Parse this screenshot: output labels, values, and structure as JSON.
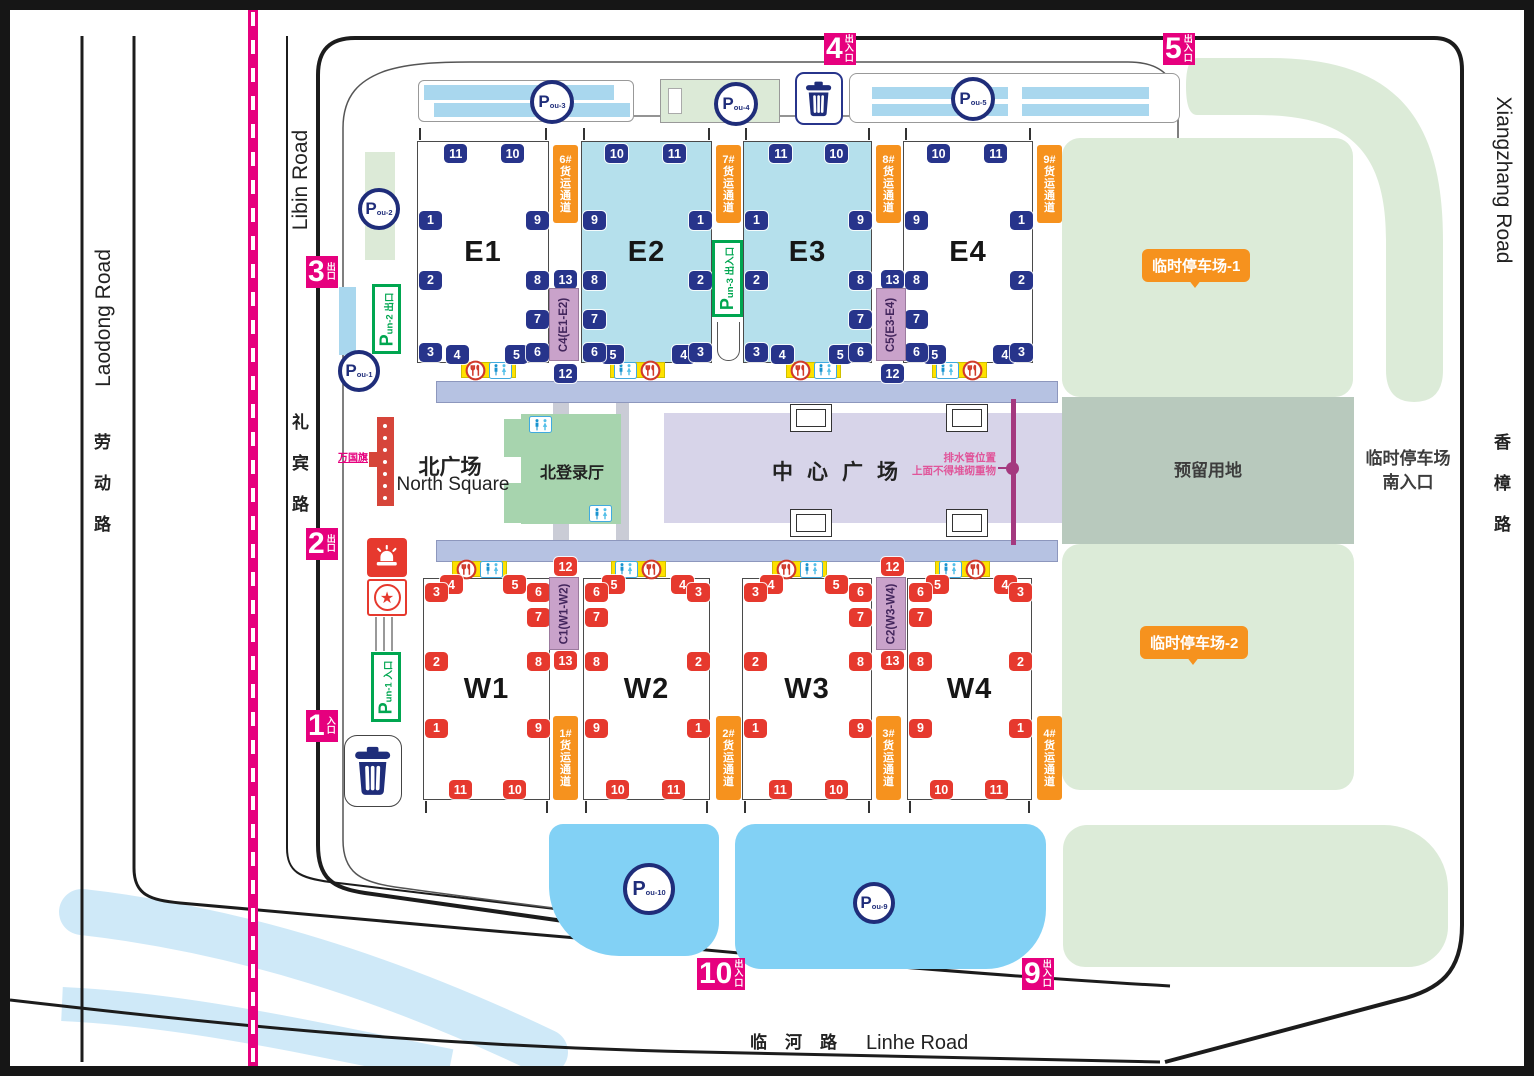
{
  "roads": {
    "laodong_en": "Laodong Road",
    "laodong_zh": "劳动路",
    "libin_en": "Libin Road",
    "libin_zh": "礼宾路",
    "xiangzhang_en": "Xiangzhang Road",
    "xiangzhang_zh": "香樟路",
    "linhe_zh": "临河路",
    "linhe_en": "Linhe Road"
  },
  "areas": {
    "north_square_zh": "北广场",
    "north_square_en": "North Square",
    "north_hall": "北登录厅",
    "central_square": "中心广场",
    "reserved": "预留用地",
    "parking1": "临时停车场-1",
    "parking2": "临时停车场-2",
    "south_entrance_line1": "临时停车场",
    "south_entrance_line2": "南入口"
  },
  "annotations": {
    "flags": "万国旗",
    "drain1": "排水管位置",
    "drain2": "上面不得堆砌重物"
  },
  "entrances": [
    {
      "id": "g1",
      "num": "1",
      "suffix": "入口"
    },
    {
      "id": "g2",
      "num": "2",
      "suffix": "出口"
    },
    {
      "id": "g3",
      "num": "3",
      "suffix": "出口"
    },
    {
      "id": "g4",
      "num": "4",
      "suffix": "出入口"
    },
    {
      "id": "g5",
      "num": "5",
      "suffix": "出入口"
    },
    {
      "id": "g9",
      "num": "9",
      "suffix": "出入口"
    },
    {
      "id": "g10",
      "num": "10",
      "suffix": "出入口"
    }
  ],
  "p_circles": [
    {
      "id": "pou1",
      "label": "Pou-1"
    },
    {
      "id": "pou2",
      "label": "Pou-2"
    },
    {
      "id": "pou3",
      "label": "Pou-3"
    },
    {
      "id": "pou4",
      "label": "Pou-4"
    },
    {
      "id": "pou5",
      "label": "Pou-5"
    },
    {
      "id": "pou9",
      "label": "Pou-9"
    },
    {
      "id": "pou10",
      "label": "Pou-10"
    }
  ],
  "p_gates": [
    {
      "id": "pun1",
      "label": "Pun-1",
      "suffix": "入口"
    },
    {
      "id": "pun2",
      "label": "Pun-2",
      "suffix": "出口"
    },
    {
      "id": "pun3",
      "label": "Pun-3",
      "suffix": "出入口"
    }
  ],
  "freight_lanes": [
    {
      "id": "lane6",
      "label": "6#货运通道"
    },
    {
      "id": "lane7",
      "label": "7#货运通道"
    },
    {
      "id": "lane8",
      "label": "8#货运通道"
    },
    {
      "id": "lane9",
      "label": "9#货运通道"
    },
    {
      "id": "lane1",
      "label": "1#货运通道"
    },
    {
      "id": "lane2",
      "label": "2#货运通道"
    },
    {
      "id": "lane3",
      "label": "3#货运通道"
    },
    {
      "id": "lane4",
      "label": "4#货运通道"
    }
  ],
  "corridor_links": [
    {
      "id": "C4",
      "label": "C4(E1-E2)",
      "top": "13",
      "bottom": "12"
    },
    {
      "id": "C5",
      "label": "C5(E3-E4)",
      "top": "13",
      "bottom": "12"
    },
    {
      "id": "C1",
      "label": "C1(W1-W2)",
      "top": "12",
      "bottom": "13"
    },
    {
      "id": "C2",
      "label": "C2(W3-W4)",
      "top": "12",
      "bottom": "13"
    }
  ],
  "halls": [
    {
      "id": "E1",
      "label": "E1",
      "pattern": "A",
      "color": "white",
      "badge": "navy"
    },
    {
      "id": "E2",
      "label": "E2",
      "pattern": "B",
      "color": "blue",
      "badge": "navy"
    },
    {
      "id": "E3",
      "label": "E3",
      "pattern": "A",
      "color": "blue",
      "badge": "navy"
    },
    {
      "id": "E4",
      "label": "E4",
      "pattern": "B",
      "color": "white",
      "badge": "navy"
    },
    {
      "id": "W1",
      "label": "W1",
      "pattern": "C",
      "color": "white",
      "badge": "red"
    },
    {
      "id": "W2",
      "label": "W2",
      "pattern": "D",
      "color": "white",
      "badge": "red"
    },
    {
      "id": "W3",
      "label": "W3",
      "pattern": "C",
      "color": "white",
      "badge": "red"
    },
    {
      "id": "W4",
      "label": "W4",
      "pattern": "D",
      "color": "white",
      "badge": "red"
    }
  ],
  "gate_patterns": {
    "A": {
      "top": [
        "wc",
        "11",
        "10",
        "wc"
      ],
      "left": [
        "1",
        "2",
        "wc",
        "3"
      ],
      "right": [
        "9",
        "8",
        "7",
        "6"
      ],
      "bottom": [
        "4",
        "5"
      ],
      "strip": [
        "rest",
        "wc"
      ]
    },
    "B": {
      "top": [
        "wc",
        "10",
        "11",
        "wc"
      ],
      "left": [
        "9",
        "8",
        "7",
        "6"
      ],
      "right": [
        "1",
        "2",
        "wc",
        "3"
      ],
      "bottom": [
        "5",
        "4"
      ],
      "strip": [
        "wc",
        "rest"
      ]
    },
    "C": {
      "top": [
        "4",
        "5"
      ],
      "left": [
        "3",
        "wc",
        "2",
        "1"
      ],
      "right": [
        "6",
        "7",
        "8",
        "9"
      ],
      "bottom": [
        "wc",
        "11",
        "10",
        "wc"
      ],
      "strip": [
        "rest",
        "wc"
      ]
    },
    "D": {
      "top": [
        "5",
        "4"
      ],
      "left": [
        "6",
        "7",
        "8",
        "9"
      ],
      "right": [
        "3",
        "wc",
        "2",
        "1"
      ],
      "bottom": [
        "wc",
        "10",
        "11",
        "wc"
      ],
      "strip": [
        "wc",
        "rest"
      ]
    }
  },
  "colors": {
    "magenta_entrance": "#e6007e",
    "navy_badge": "#27348b",
    "red_badge": "#e6392e",
    "orange_lane": "#f6921e",
    "hall_blue": "#b5e0ec",
    "parking_green": "#dcebd8",
    "reserved_green": "#b8c9bd",
    "central_lavender": "#d7d4e9",
    "walkway_blue": "#b6c2e2",
    "lot_blue": "#82d1f5",
    "p_green": "#00a650",
    "pipe_plum": "#a4397f",
    "corridor_purple": "#c9a2ca",
    "yellow_strip": "#ffe100",
    "river_blue": "#cfe9f8"
  }
}
